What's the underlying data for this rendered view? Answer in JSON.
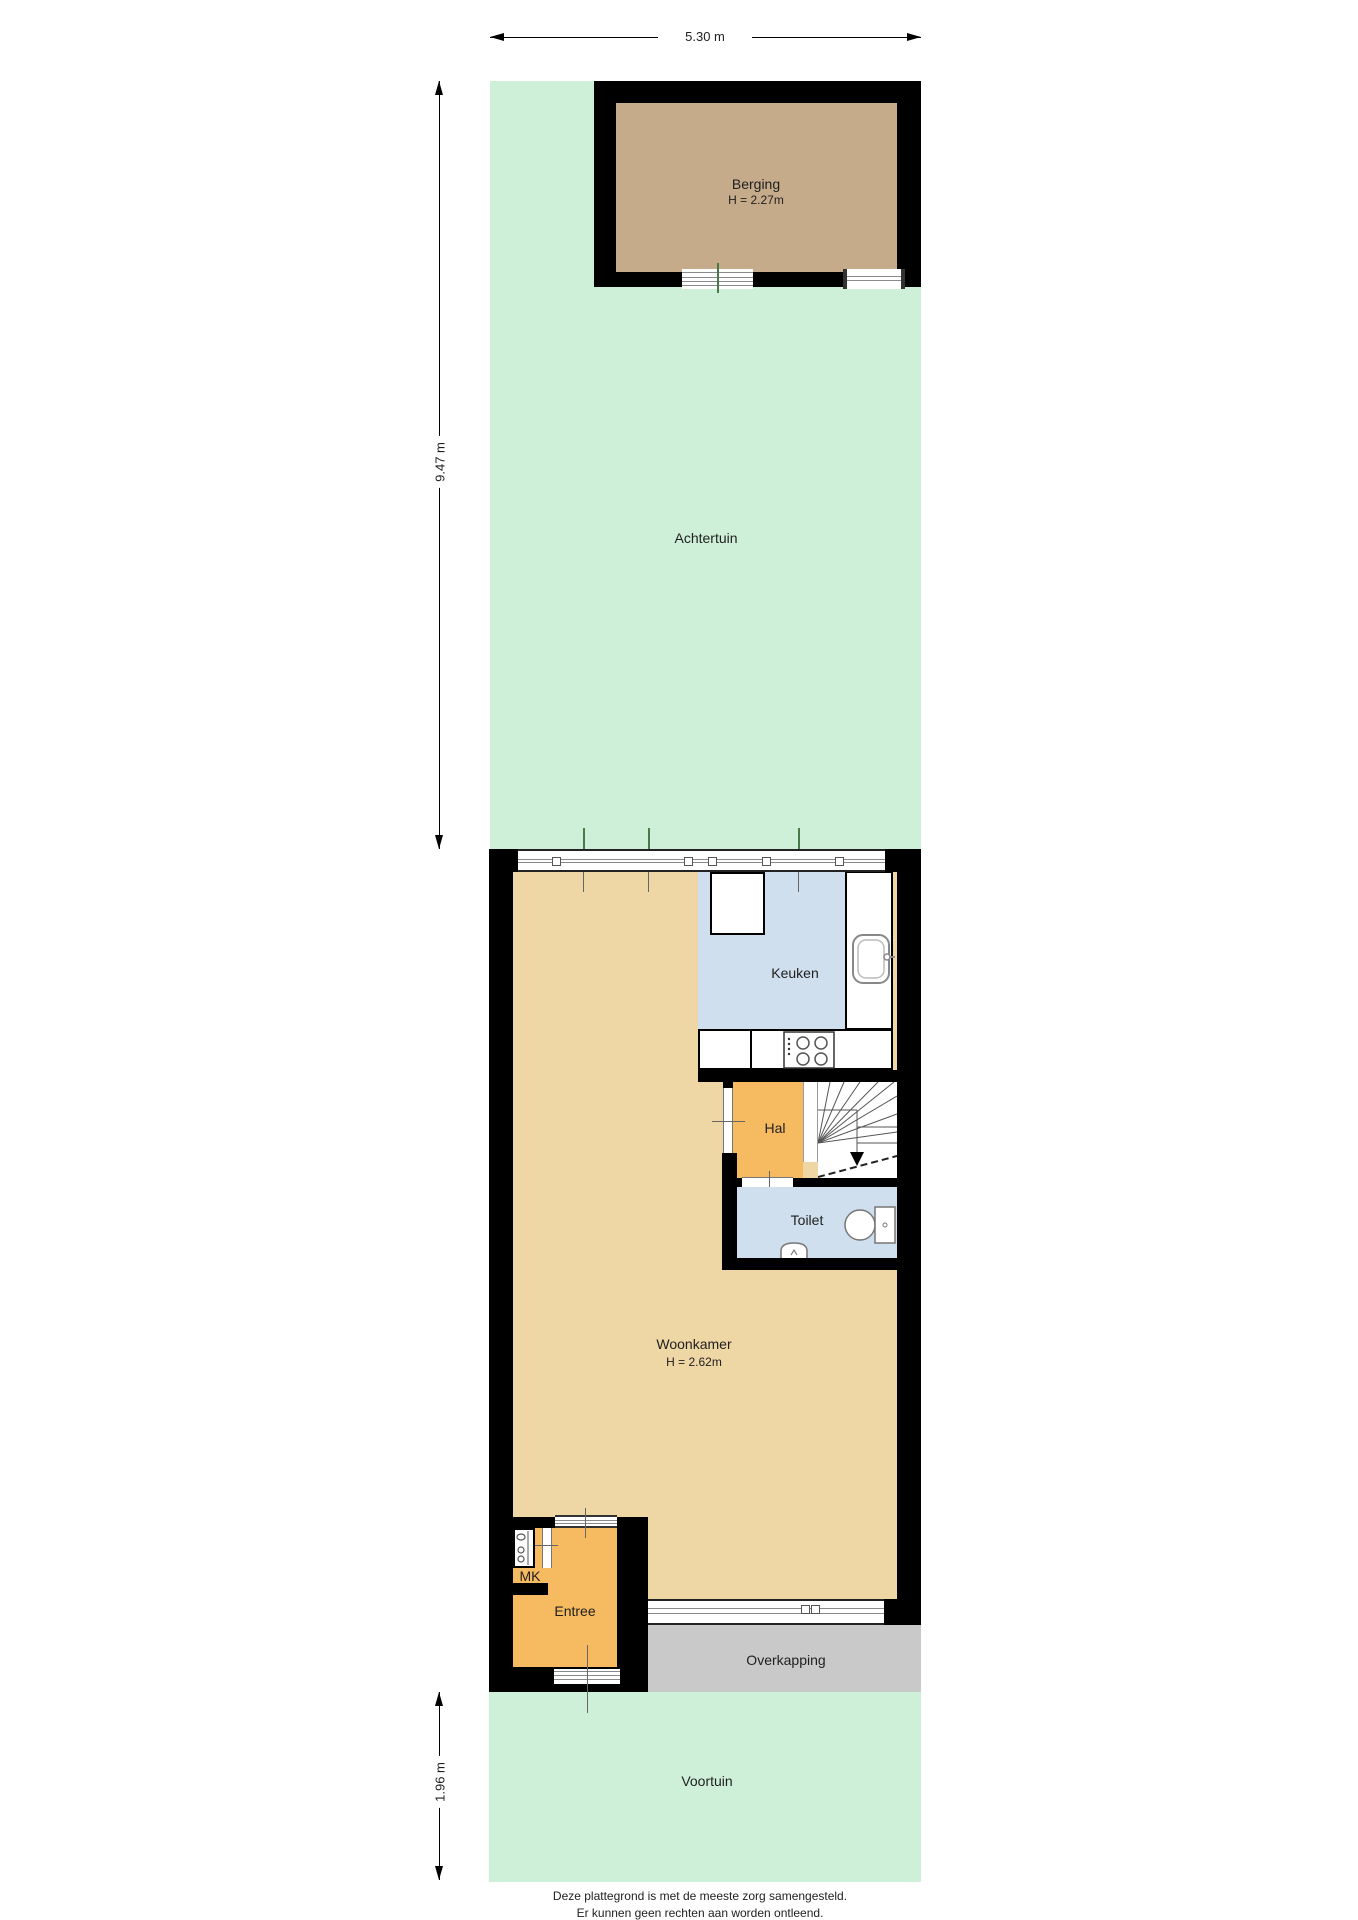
{
  "plan": {
    "rooms": {
      "berging": {
        "label": "Berging",
        "height": "H = 2.27m"
      },
      "achtertuin": {
        "label": "Achtertuin"
      },
      "keuken": {
        "label": "Keuken"
      },
      "hal": {
        "label": "Hal"
      },
      "toilet": {
        "label": "Toilet"
      },
      "woonkamer": {
        "label": "Woonkamer",
        "height": "H = 2.62m"
      },
      "mk": {
        "label": "MK"
      },
      "entree": {
        "label": "Entree"
      },
      "overkapping": {
        "label": "Overkapping"
      },
      "voortuin": {
        "label": "Voortuin"
      }
    },
    "dimensions": {
      "plot_width": "5.30 m",
      "back_garden_depth": "9.47 m",
      "front_garden_depth": "1.96 m"
    },
    "footer": {
      "line1": "Deze plattegrond is met de meeste zorg samengesteld.",
      "line2": "Er kunnen geen rechten aan worden ontleend."
    },
    "colors": {
      "garden": "#cff0d8",
      "berging_floor": "#c5ab8a",
      "living_floor": "#efd6a5",
      "hall_floor": "#f6ba60",
      "wet_floor": "#cfdfed",
      "canopy": "#c9c9c9",
      "wall": "#000000",
      "glaze": "#8a8a8a",
      "tick_green": "#4a7a4a",
      "tick_gray": "#666666",
      "text": "#1f1f1f"
    }
  }
}
